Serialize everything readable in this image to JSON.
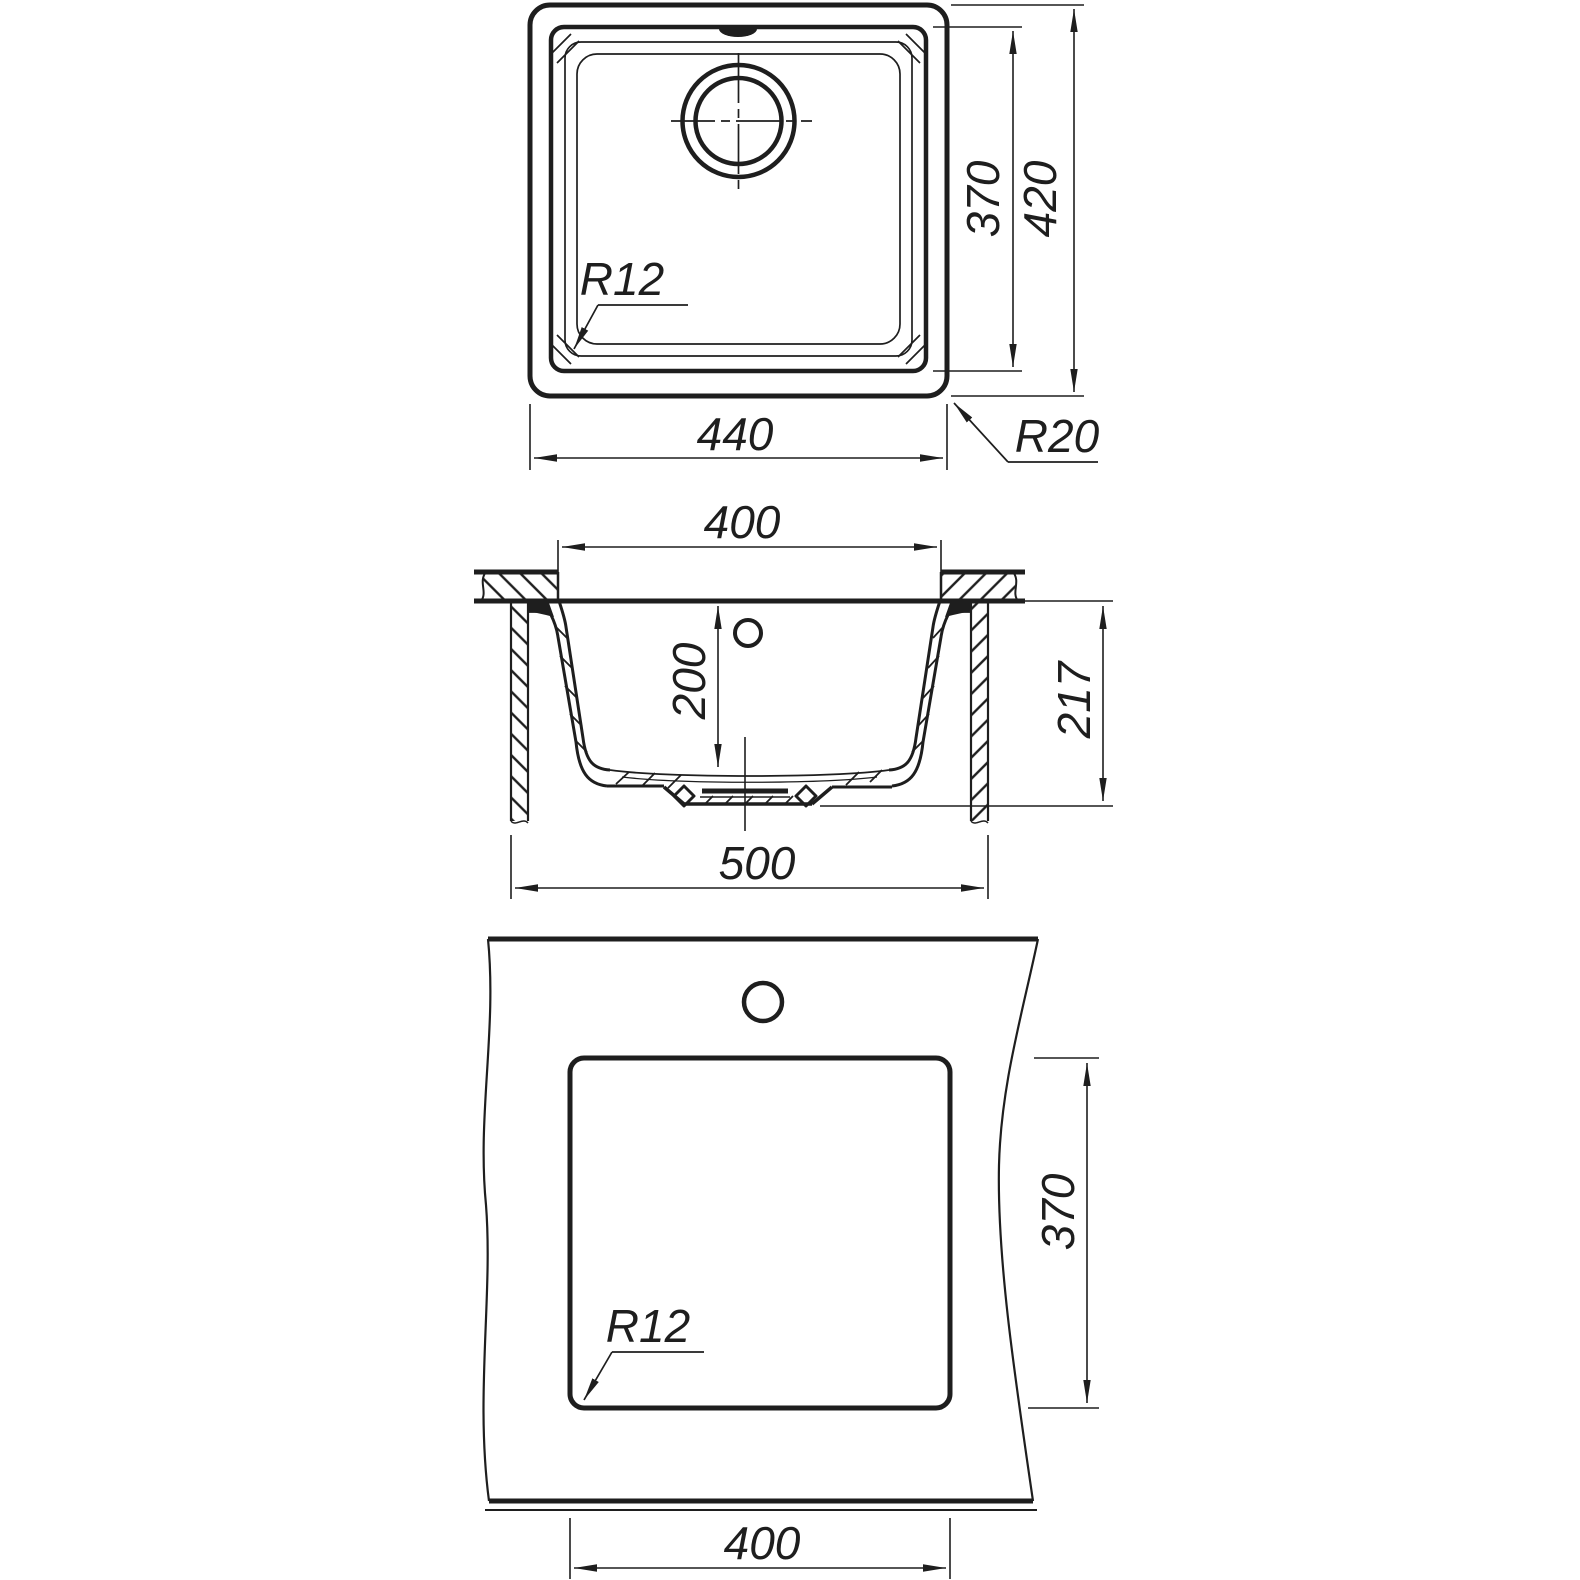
{
  "drawing": {
    "kind": "sink-technical-drawing",
    "colors": {
      "background": "#ffffff",
      "line": "#1e1e1e"
    }
  },
  "views": {
    "top": {
      "width_label": "440",
      "height_label": "420",
      "bowl_height_label": "370",
      "bowl_corner_radius_label": "R12",
      "outer_corner_radius_label": "R20"
    },
    "section": {
      "bowl_width_label": "400",
      "depth_label": "200",
      "height_label": "217",
      "overall_width_label": "500"
    },
    "cutout": {
      "width_label": "400",
      "height_label": "370",
      "corner_radius_label": "R12"
    }
  }
}
